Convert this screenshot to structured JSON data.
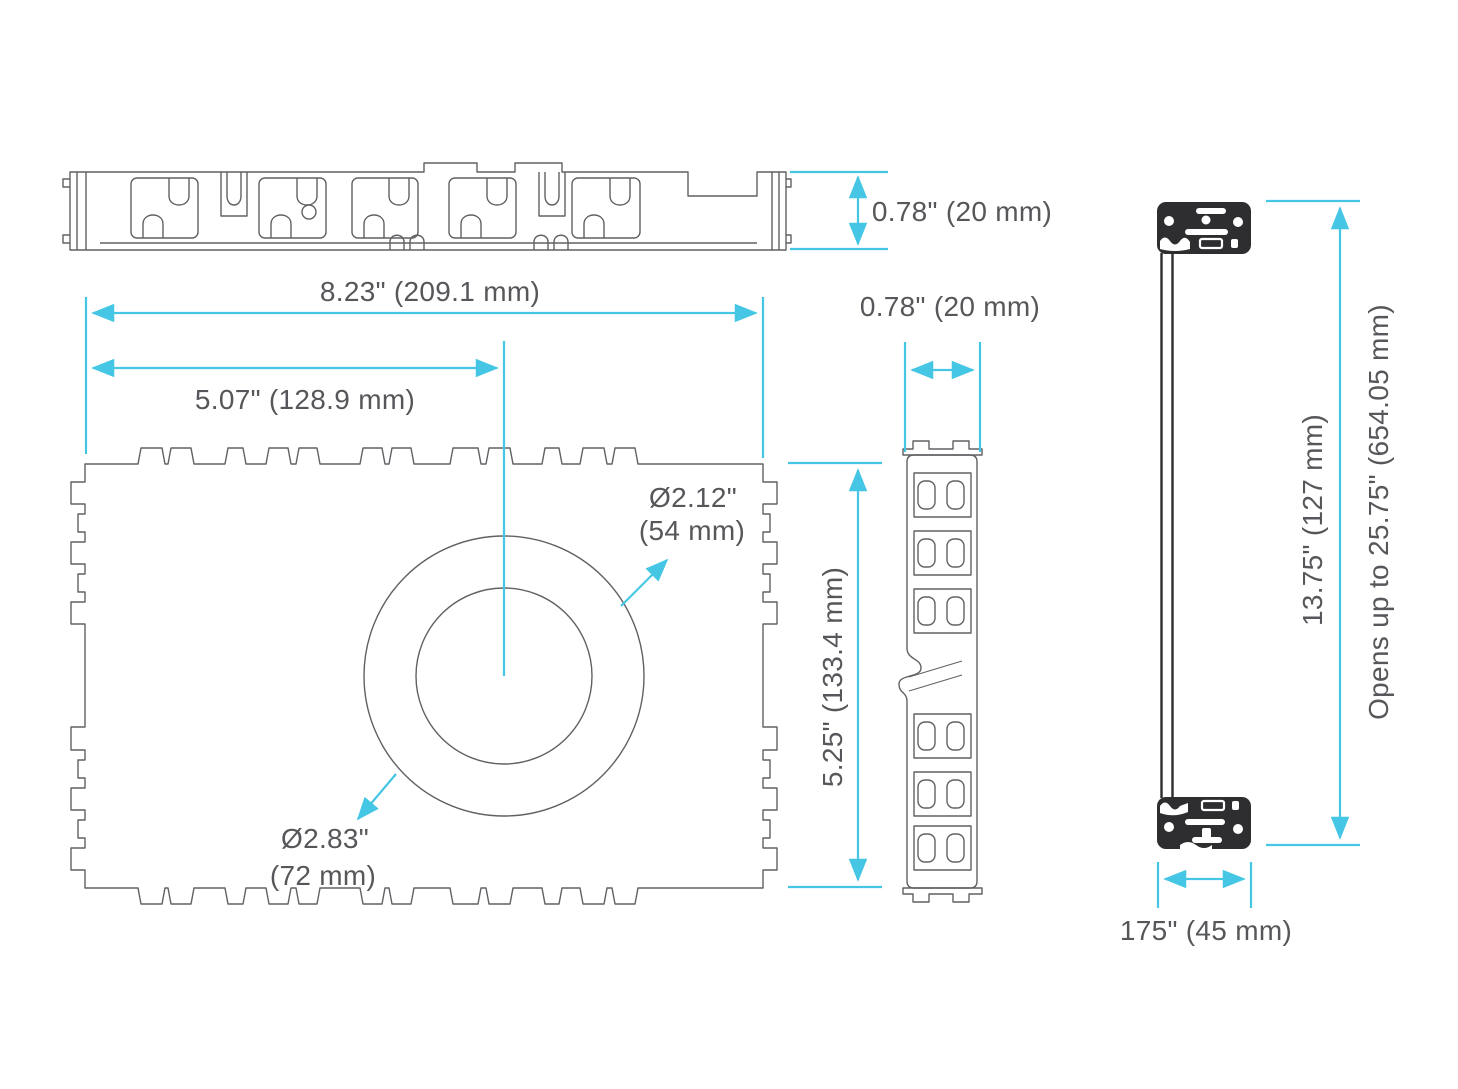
{
  "colors": {
    "dimension_accent": "#44C6E4",
    "drawing_line": "#606165",
    "text": "#56575A",
    "solid_block": "#2E2E30"
  },
  "dimensions": {
    "top_view_height": "0.78\" (20 mm)",
    "overall_width": "8.23\" (209.1 mm)",
    "center_offset": "5.07\" (128.9 mm)",
    "side_view_width": "0.78\" (20 mm)",
    "front_height": "5.25\" (133.4 mm)",
    "inner_diameter": {
      "line1": "Ø2.12\"",
      "line2": "(54 mm)"
    },
    "outer_diameter": {
      "line1": "Ø2.83\"",
      "line2": "(72 mm)"
    },
    "closed_height": "13.75\" (127 mm)",
    "open_height": "Opens up to 25.75\" (654.05 mm)",
    "open_depth": "175\" (45 mm)"
  }
}
